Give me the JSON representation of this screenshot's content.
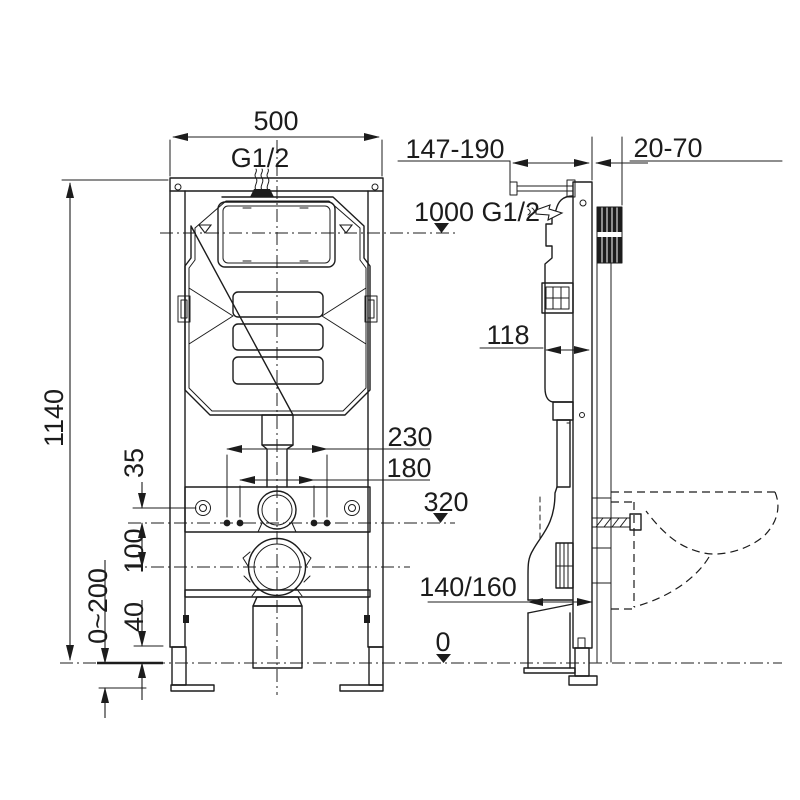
{
  "drawing": {
    "type": "technical-installation-diagram",
    "subject": "concealed cistern wall-hung toilet frame, front and side views",
    "colors": {
      "line": "#1c1c1c",
      "background": "#ffffff"
    },
    "labels": {
      "front_width": "500",
      "front_inlet": "G1/2",
      "front_height": "1140",
      "bolt_spacing_outer": "230",
      "bolt_spacing_inner": "180",
      "level_320": "320",
      "dim_35": "35",
      "dim_100": "100",
      "leg_adjust": "0~200",
      "dim_40": "40",
      "side_depth_adjust": "147-190",
      "side_wall_thickness": "20-70",
      "side_level_1000": "1000 G1/2",
      "side_depth_118": "118",
      "outlet_size": "140/160",
      "level_zero": "0"
    }
  }
}
